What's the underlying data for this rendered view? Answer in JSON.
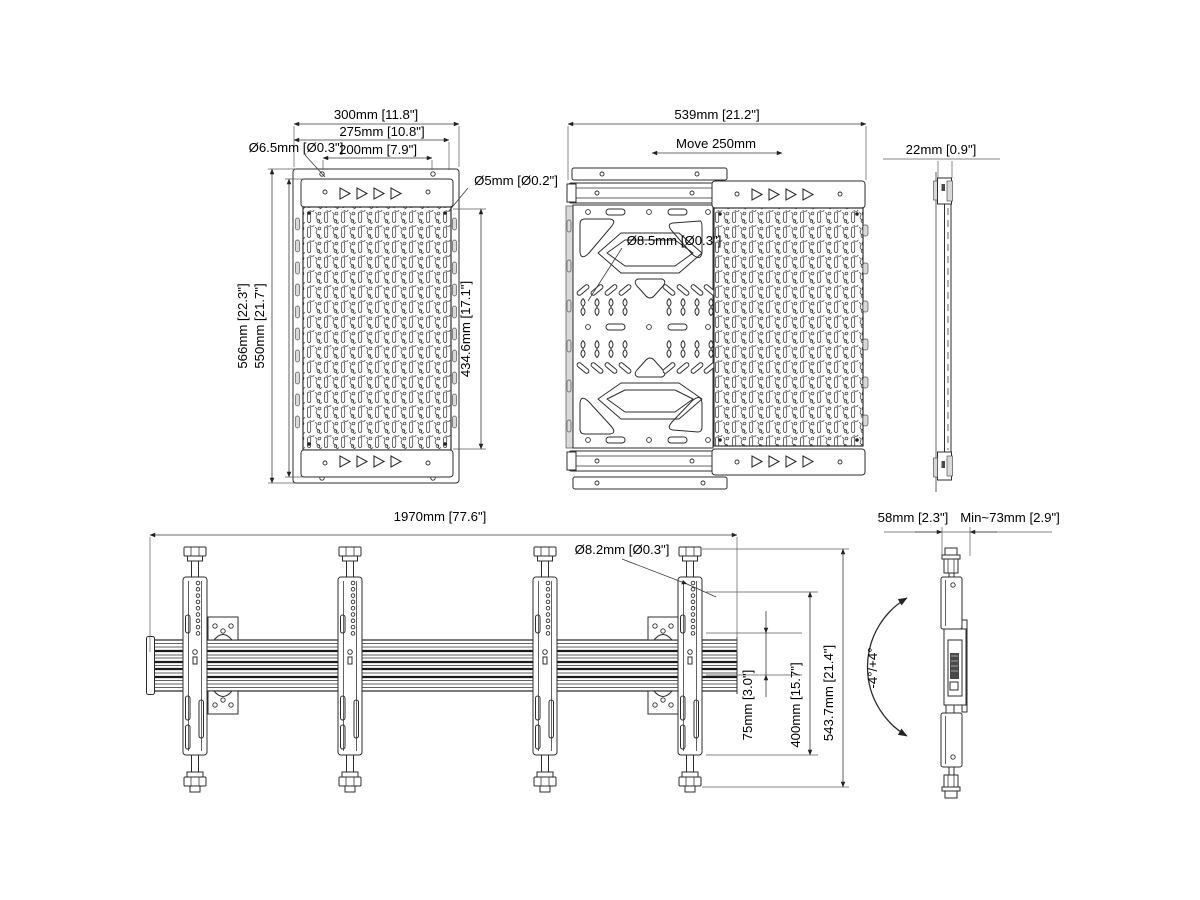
{
  "drawing": {
    "labels": {
      "v1": {
        "w300": "300mm [11.8\"]",
        "w275": "275mm [10.8\"]",
        "w200": "200mm [7.9\"]",
        "d65": "Ø6.5mm [Ø0.3\"]",
        "d5": "Ø5mm [Ø0.2\"]",
        "h566": "566mm [22.3\"]",
        "h550": "550mm [21.7\"]",
        "h434": "434.6mm [17.1\"]"
      },
      "v2": {
        "w539": "539mm [21.2\"]",
        "move": "Move 250mm",
        "d85": "Ø8.5mm [Ø0.3\"]"
      },
      "v3": {
        "d22": "22mm [0.9\"]"
      },
      "v4": {
        "len": "1970mm [77.6\"]",
        "d82": "Ø8.2mm [Ø0.3\"]",
        "s75": "75mm [3.0\"]",
        "s400": "400mm [15.7\"]",
        "h543": "543.7mm [21.4\"]"
      },
      "v5": {
        "d58": "58mm [2.3\"]",
        "d73": "Min~73mm [2.9\"]",
        "tilt": "-4°/+4°"
      }
    },
    "line_color": "#2e2e2e",
    "dim_color": "#3a3a3a"
  }
}
